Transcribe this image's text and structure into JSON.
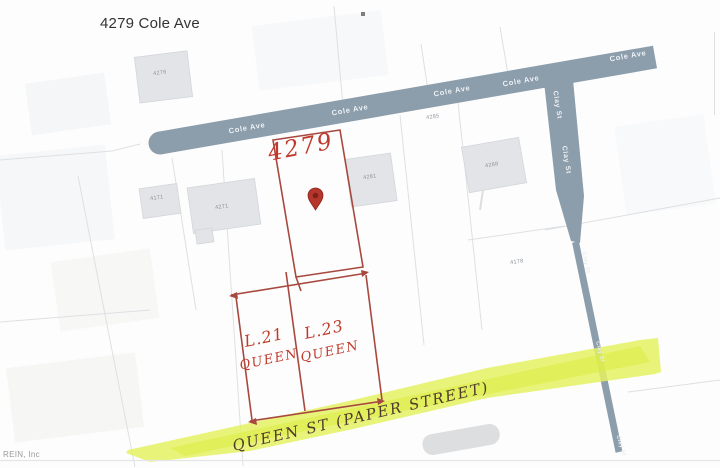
{
  "page": {
    "title": "4279 Cole Ave",
    "watermark": "REIN, Inc"
  },
  "roads": {
    "cole_ave": "Cole Ave",
    "clay_st": "Clay St",
    "queen_st": "QUEEN ST (PAPER STREET)"
  },
  "subject_parcel": {
    "number": "4279",
    "marker_icon": "map-pin"
  },
  "queen_lots": [
    {
      "lot": "L.21",
      "street": "QUEEN"
    },
    {
      "lot": "L.23",
      "street": "QUEEN"
    }
  ],
  "parcel_numbers": [
    "4276",
    "4285",
    "4288",
    "4281",
    "4271",
    "4171",
    "4178"
  ],
  "colors": {
    "road": "#8c9dab",
    "parcel_outline": "#a8493f",
    "handwriting_red": "#c03a2b",
    "queen_st_ink": "#4f392d",
    "highlight_yellow": "#e4f162",
    "building": "#e2e4e8"
  }
}
